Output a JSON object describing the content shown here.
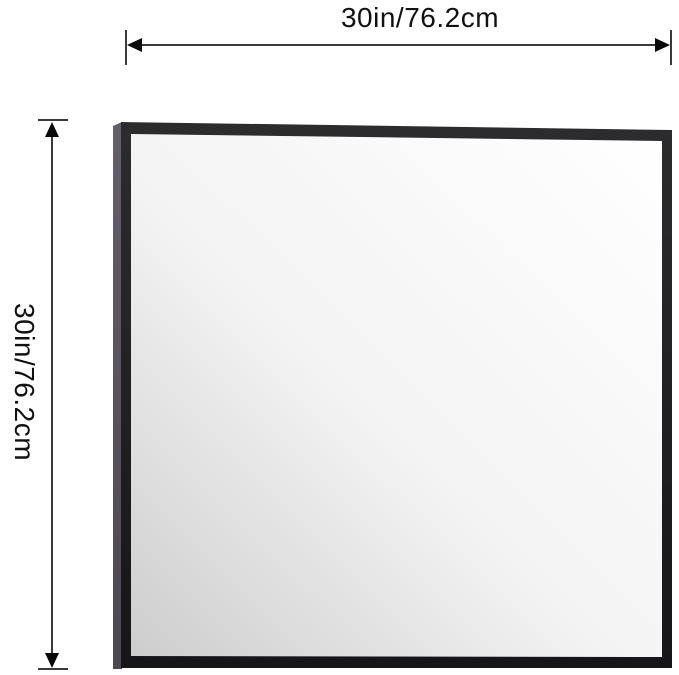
{
  "diagram": {
    "title": "mirror-dimension-diagram",
    "width_label": "30in/76.2cm",
    "height_label": "30in/76.2cm"
  },
  "colors": {
    "background": "#ffffff",
    "text": "#111111",
    "dimension_line": "#3a3a3a",
    "arrow": "#0a0a0a",
    "frame_top": "#2c2c2e",
    "frame_bottom": "#161618",
    "frame_side_top": "#655e6b",
    "frame_side_bottom": "#4d4751",
    "glass_light": "#ffffff",
    "glass_mid": "#f3f3f3",
    "glass_dark": "#cdcdcd"
  }
}
